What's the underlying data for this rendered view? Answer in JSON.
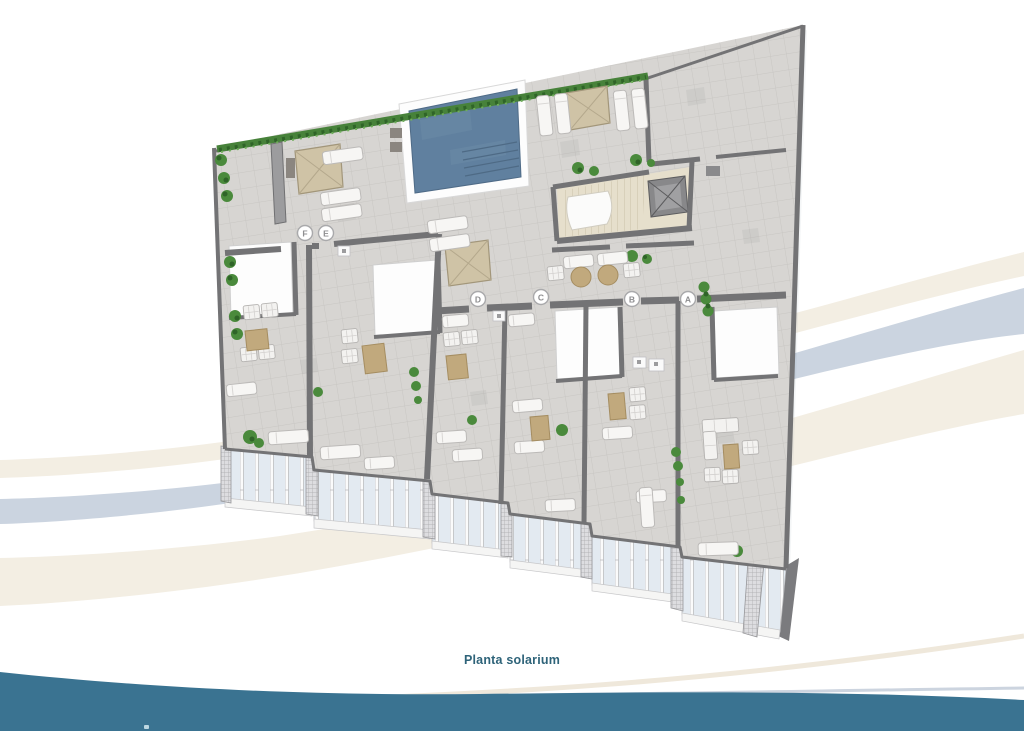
{
  "caption": {
    "text": "Planta solarium",
    "color": "#2e6379"
  },
  "units": [
    {
      "label": "F"
    },
    {
      "label": "E"
    },
    {
      "label": "D"
    },
    {
      "label": "C"
    },
    {
      "label": "B"
    },
    {
      "label": "A"
    }
  ],
  "colors": {
    "teal_wave": "#3a7391",
    "swoosh_cream": "#f3eee3",
    "swoosh_blue": "#cbd4e0",
    "floor_tile": "#d7d5d2",
    "wall_gray": "#737375",
    "pool_water": "#60809f",
    "pool_deck": "#fdfdfd",
    "parasol_tan": "#cfc3a6",
    "hedge_green": "#47823a",
    "core_floor": "#e6dfcc",
    "glass_blue": "#e3eaf1",
    "table_tan": "#c1a97d"
  }
}
